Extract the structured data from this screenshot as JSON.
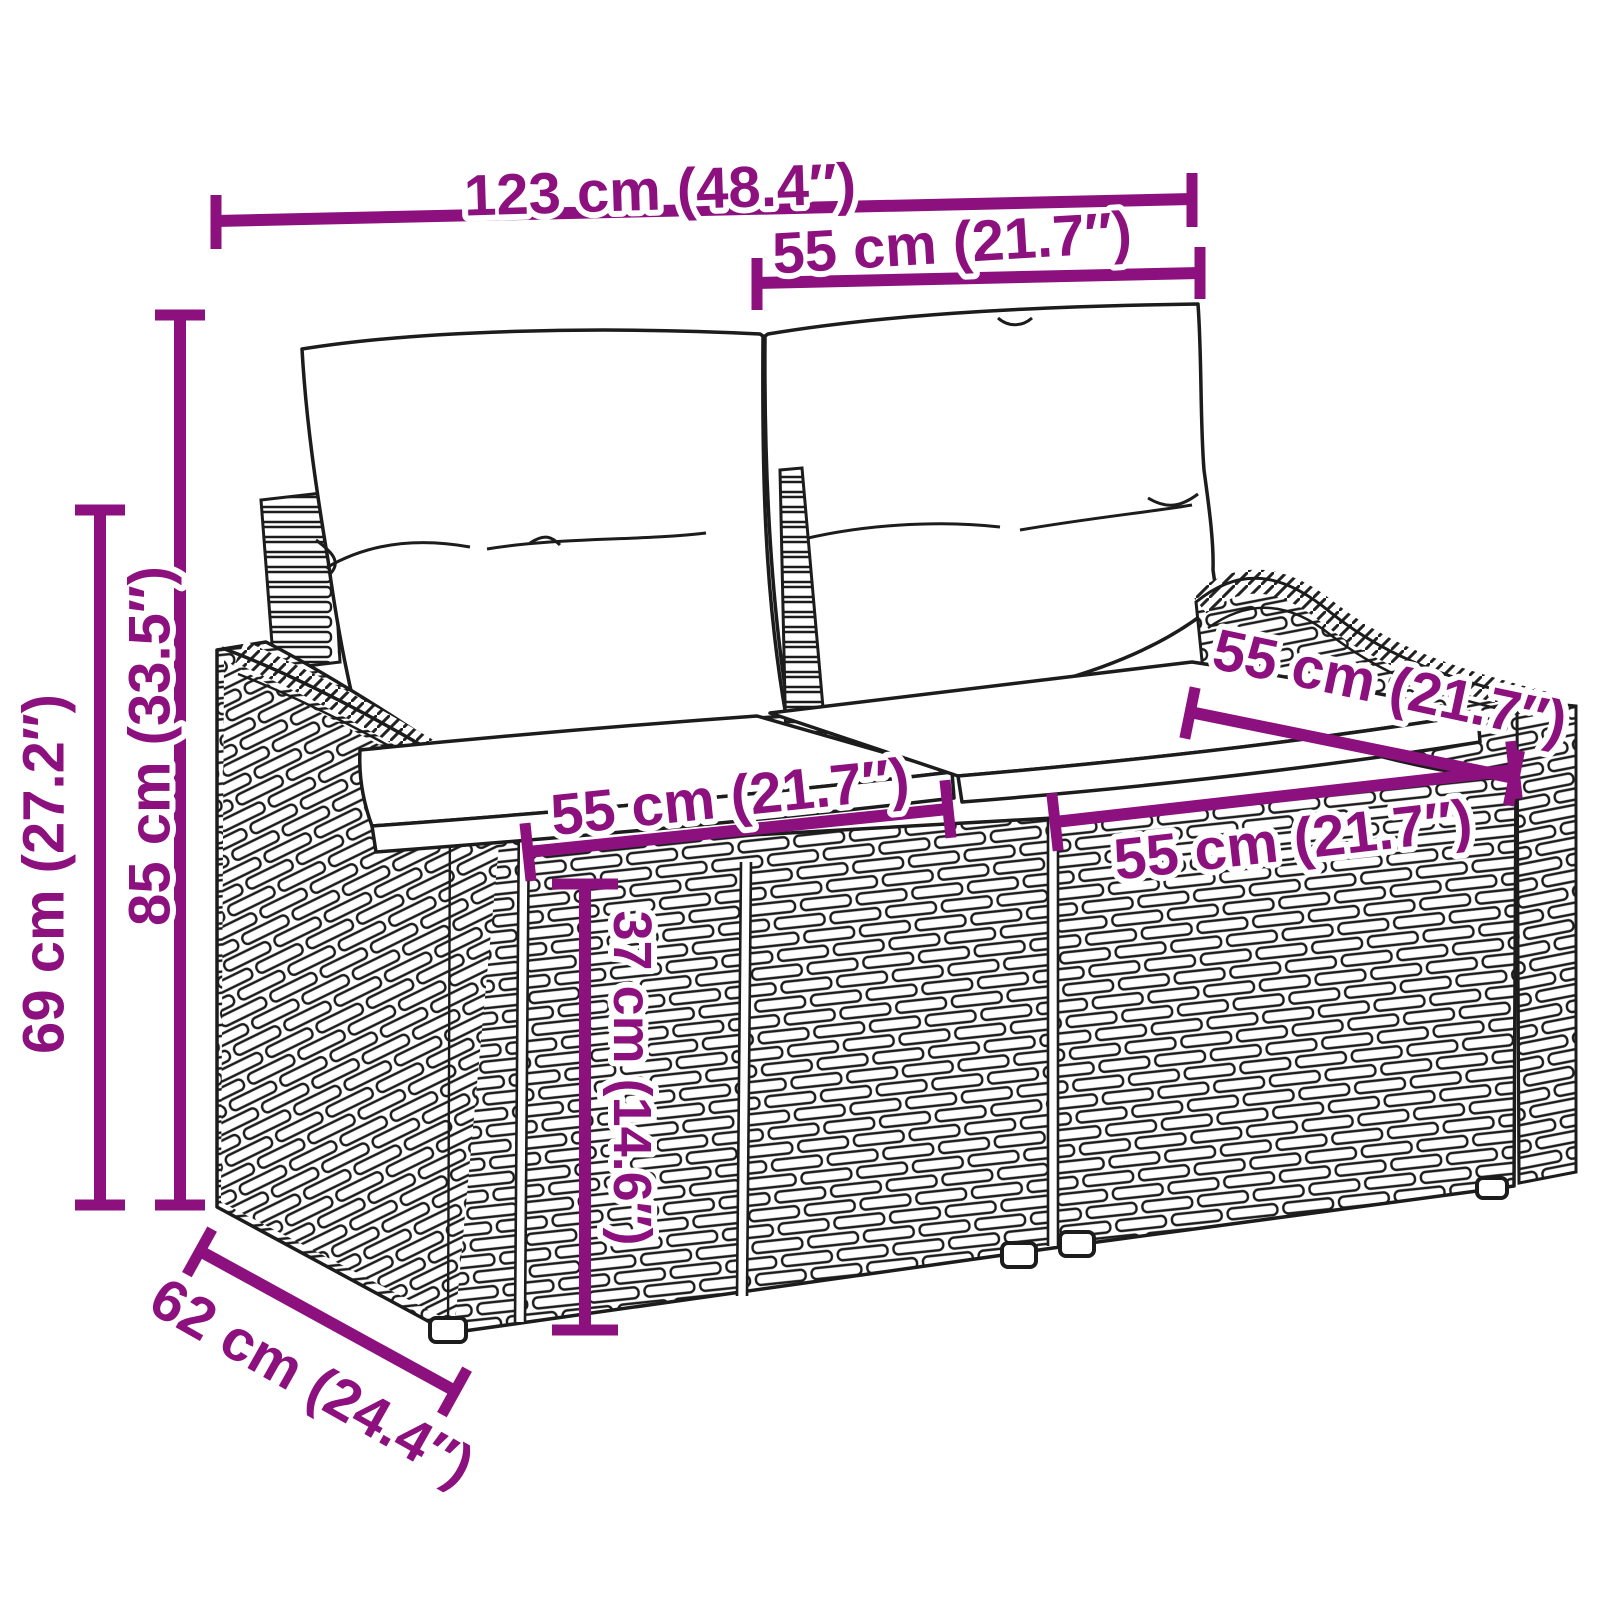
{
  "diagram": {
    "type": "product-dimension-diagram",
    "subject": "poly-rattan 2-seater garden sofa with back and seat cushions",
    "accent_color": "#8c107e",
    "line_color": "#1c1c1c",
    "background_color": "#ffffff",
    "dimensions": [
      {
        "id": "overall-width",
        "label": "123 cm (48.4″)"
      },
      {
        "id": "backrest-width",
        "label": "55 cm (21.7″)"
      },
      {
        "id": "overall-height",
        "label": "85 cm (33.5″)"
      },
      {
        "id": "armrest-height",
        "label": "69 cm (27.2″)"
      },
      {
        "id": "seat-depth",
        "label": "55 cm (21.7″)"
      },
      {
        "id": "seat-width-left",
        "label": "55 cm (21.7″)"
      },
      {
        "id": "seat-width-right",
        "label": "55 cm (21.7″)"
      },
      {
        "id": "seat-height",
        "label": "37 cm (14.6″)"
      },
      {
        "id": "overall-depth",
        "label": "62 cm (24.4″)"
      }
    ]
  }
}
